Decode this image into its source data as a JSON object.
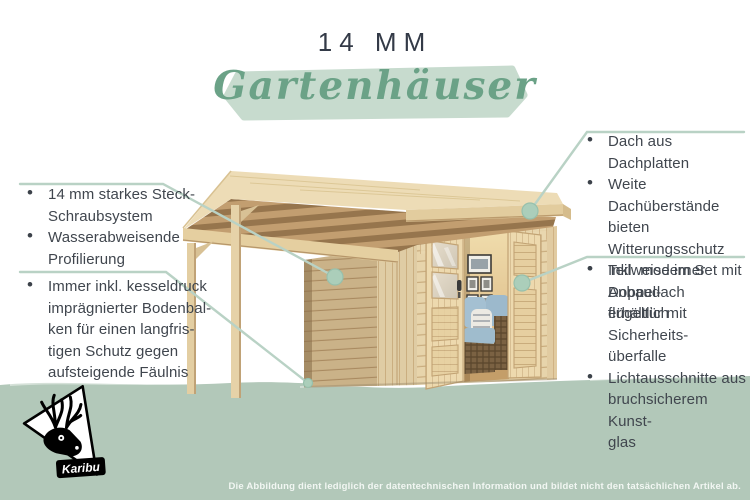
{
  "title": "14 MM",
  "subtitle": "Gartenhäuser",
  "brand": "Karibu",
  "disclaimer": "Die Abbildung dient lediglich der datentechnischen Information und bildet nicht den tatsächlichen Artikel ab.",
  "callouts": {
    "left_top": [
      "14 mm starkes Steck-\nSchraubsystem",
      "Wasserabweisende\nProfilierung"
    ],
    "left_bottom": [
      "Immer inkl. kesseldruck\nimprägnierter Bodenbal-\nken für einen langfris-\ntigen Schutz gegen\naufsteigende Fäulnis"
    ],
    "right_top": [
      "Dach aus Dachplatten",
      "Weite Dachüberstände\nbieten Witterungsschutz",
      "Teilweise im Set mit\nAnbaudach erhältlich"
    ],
    "right_bottom": [
      "Inkl. moderner Doppel-\nflügeltür mit Sicherheits-\nüberfalle",
      "Lichtausschnitte aus\nbruchsicherem Kunst-\nglas"
    ]
  },
  "illustration": {
    "subject": "wooden garden house with side canopy, open double doors, interior sofa and picture frames"
  },
  "colors": {
    "accent_green": "#6ba287",
    "brush_background": "#c7dbce",
    "ground_band": "#b2c8b9",
    "callout_line": "#b9d2c5",
    "callout_dot": "#abceba",
    "text": "#40464e",
    "title": "#333a47",
    "wood_light": "#e7d4ab",
    "wood_shadow": "#a28059"
  }
}
